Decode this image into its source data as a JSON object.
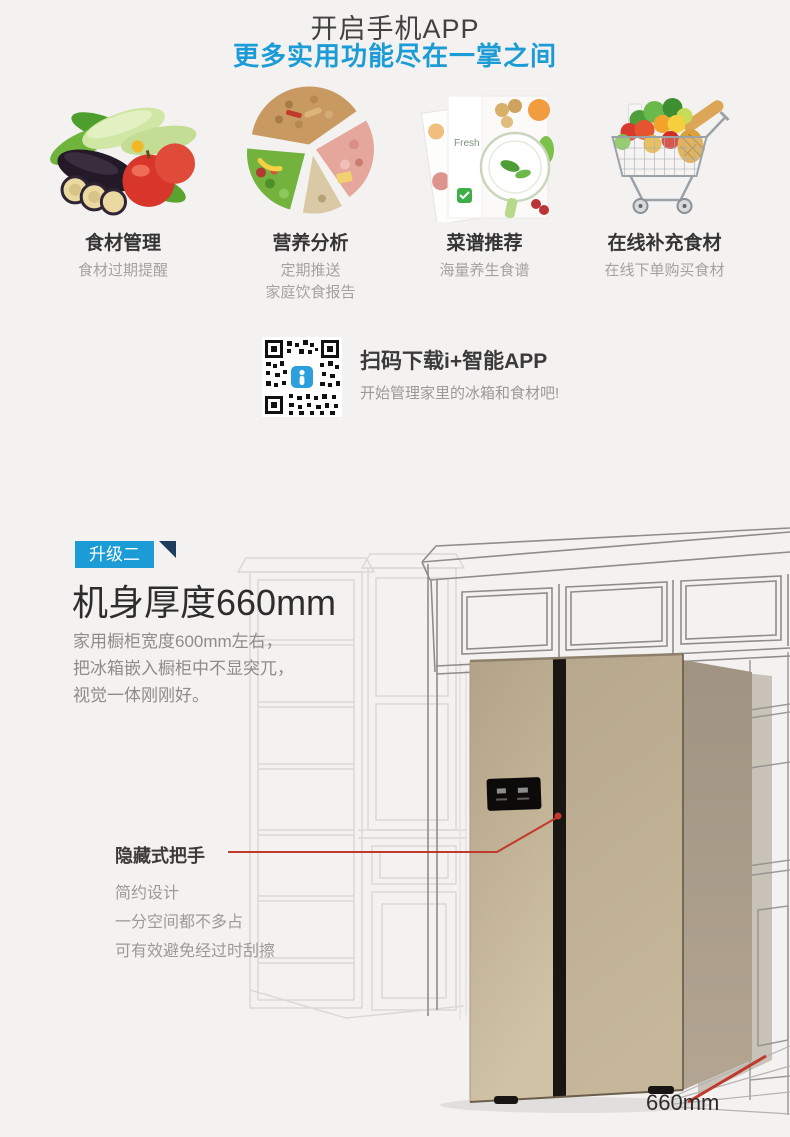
{
  "header": {
    "title": "开启手机APP",
    "subtitle": "更多实用功能尽在一掌之间"
  },
  "features": [
    {
      "title": "食材管理",
      "lines": [
        "食材过期提醒",
        ""
      ]
    },
    {
      "title": "营养分析",
      "lines": [
        "定期推送",
        "家庭饮食报告"
      ]
    },
    {
      "title": "菜谱推荐",
      "lines": [
        "海量养生食谱",
        ""
      ]
    },
    {
      "title": "在线补充食材",
      "lines": [
        "在线下单购买食材",
        ""
      ]
    }
  ],
  "qr_section": {
    "title": "扫码下载i+智能APP",
    "subtitle": "开始管理家里的冰箱和食材吧!"
  },
  "upgrade_section": {
    "badge": "升级二",
    "title": "机身厚度660mm",
    "desc_lines": [
      "家用橱柜宽度600mm左右，",
      "把冰箱嵌入橱柜中不显突兀，",
      "视觉一体刚刚好。"
    ]
  },
  "handle_callout": {
    "title": "隐藏式把手",
    "lines": [
      "简约设计",
      "一分空间都不多占",
      "可有效避免经过时刮擦"
    ]
  },
  "dimension": {
    "label": "660mm"
  },
  "recipe_card": {
    "text": "Fresh"
  },
  "colors": {
    "accent_blue": "#1b9cd6",
    "accent_red": "#c2392d",
    "badge_corner": "#1d3c5e",
    "fridge_gold": "#bfb095"
  }
}
